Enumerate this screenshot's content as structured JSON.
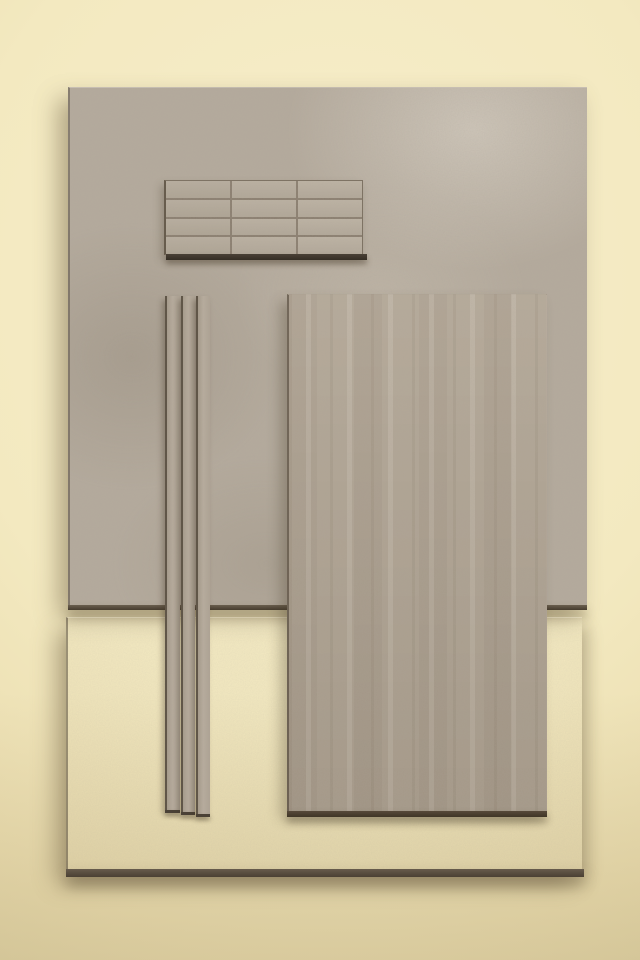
{
  "scene": {
    "description": "Flat-lay photograph of stone-look porcelain tile samples on a cream plaster wall",
    "objects": [
      {
        "name": "large-stone-slab-tile",
        "x": 68,
        "y": 87,
        "width": 517,
        "height": 517,
        "finish": "mottled matte stone"
      },
      {
        "name": "brick-mosaic-tile",
        "x": 164,
        "y": 180,
        "width": 196,
        "height": 73,
        "grid": "3 columns x 4 rows"
      },
      {
        "name": "pencil-liner-tile-1",
        "x": 165,
        "y": 296,
        "width": 13,
        "height": 514,
        "finish": "stone stick"
      },
      {
        "name": "pencil-liner-tile-2",
        "x": 181,
        "y": 296,
        "width": 12,
        "height": 516,
        "finish": "stone stick"
      },
      {
        "name": "pencil-liner-tile-3",
        "x": 196,
        "y": 296,
        "width": 12,
        "height": 518,
        "finish": "stone stick"
      },
      {
        "name": "vertical-field-tile",
        "x": 287,
        "y": 294,
        "width": 257,
        "height": 516,
        "finish": "linear veined stone"
      },
      {
        "name": "ribbed-strip-tile",
        "x": 66,
        "y": 617,
        "width": 514,
        "height": 251,
        "finish": "fluted horizontal relief"
      }
    ]
  },
  "palette": {
    "wall_center": "#f7eecb",
    "wall_mid": "#f3e9c0",
    "wall_deep": "#eadcae",
    "wall_edge": "#dccfa0",
    "slab_base": "#b4aa9c",
    "vtile_base": "#b2a695",
    "rib_base": "#a79c8e",
    "rib_groove": "#6b6052",
    "rib_highlight": "#c0b5a3",
    "grout": "#8a7e6f",
    "edge_dark": "#463c2f",
    "cast_shadow": "rgba(100,85,58,0.45)"
  }
}
